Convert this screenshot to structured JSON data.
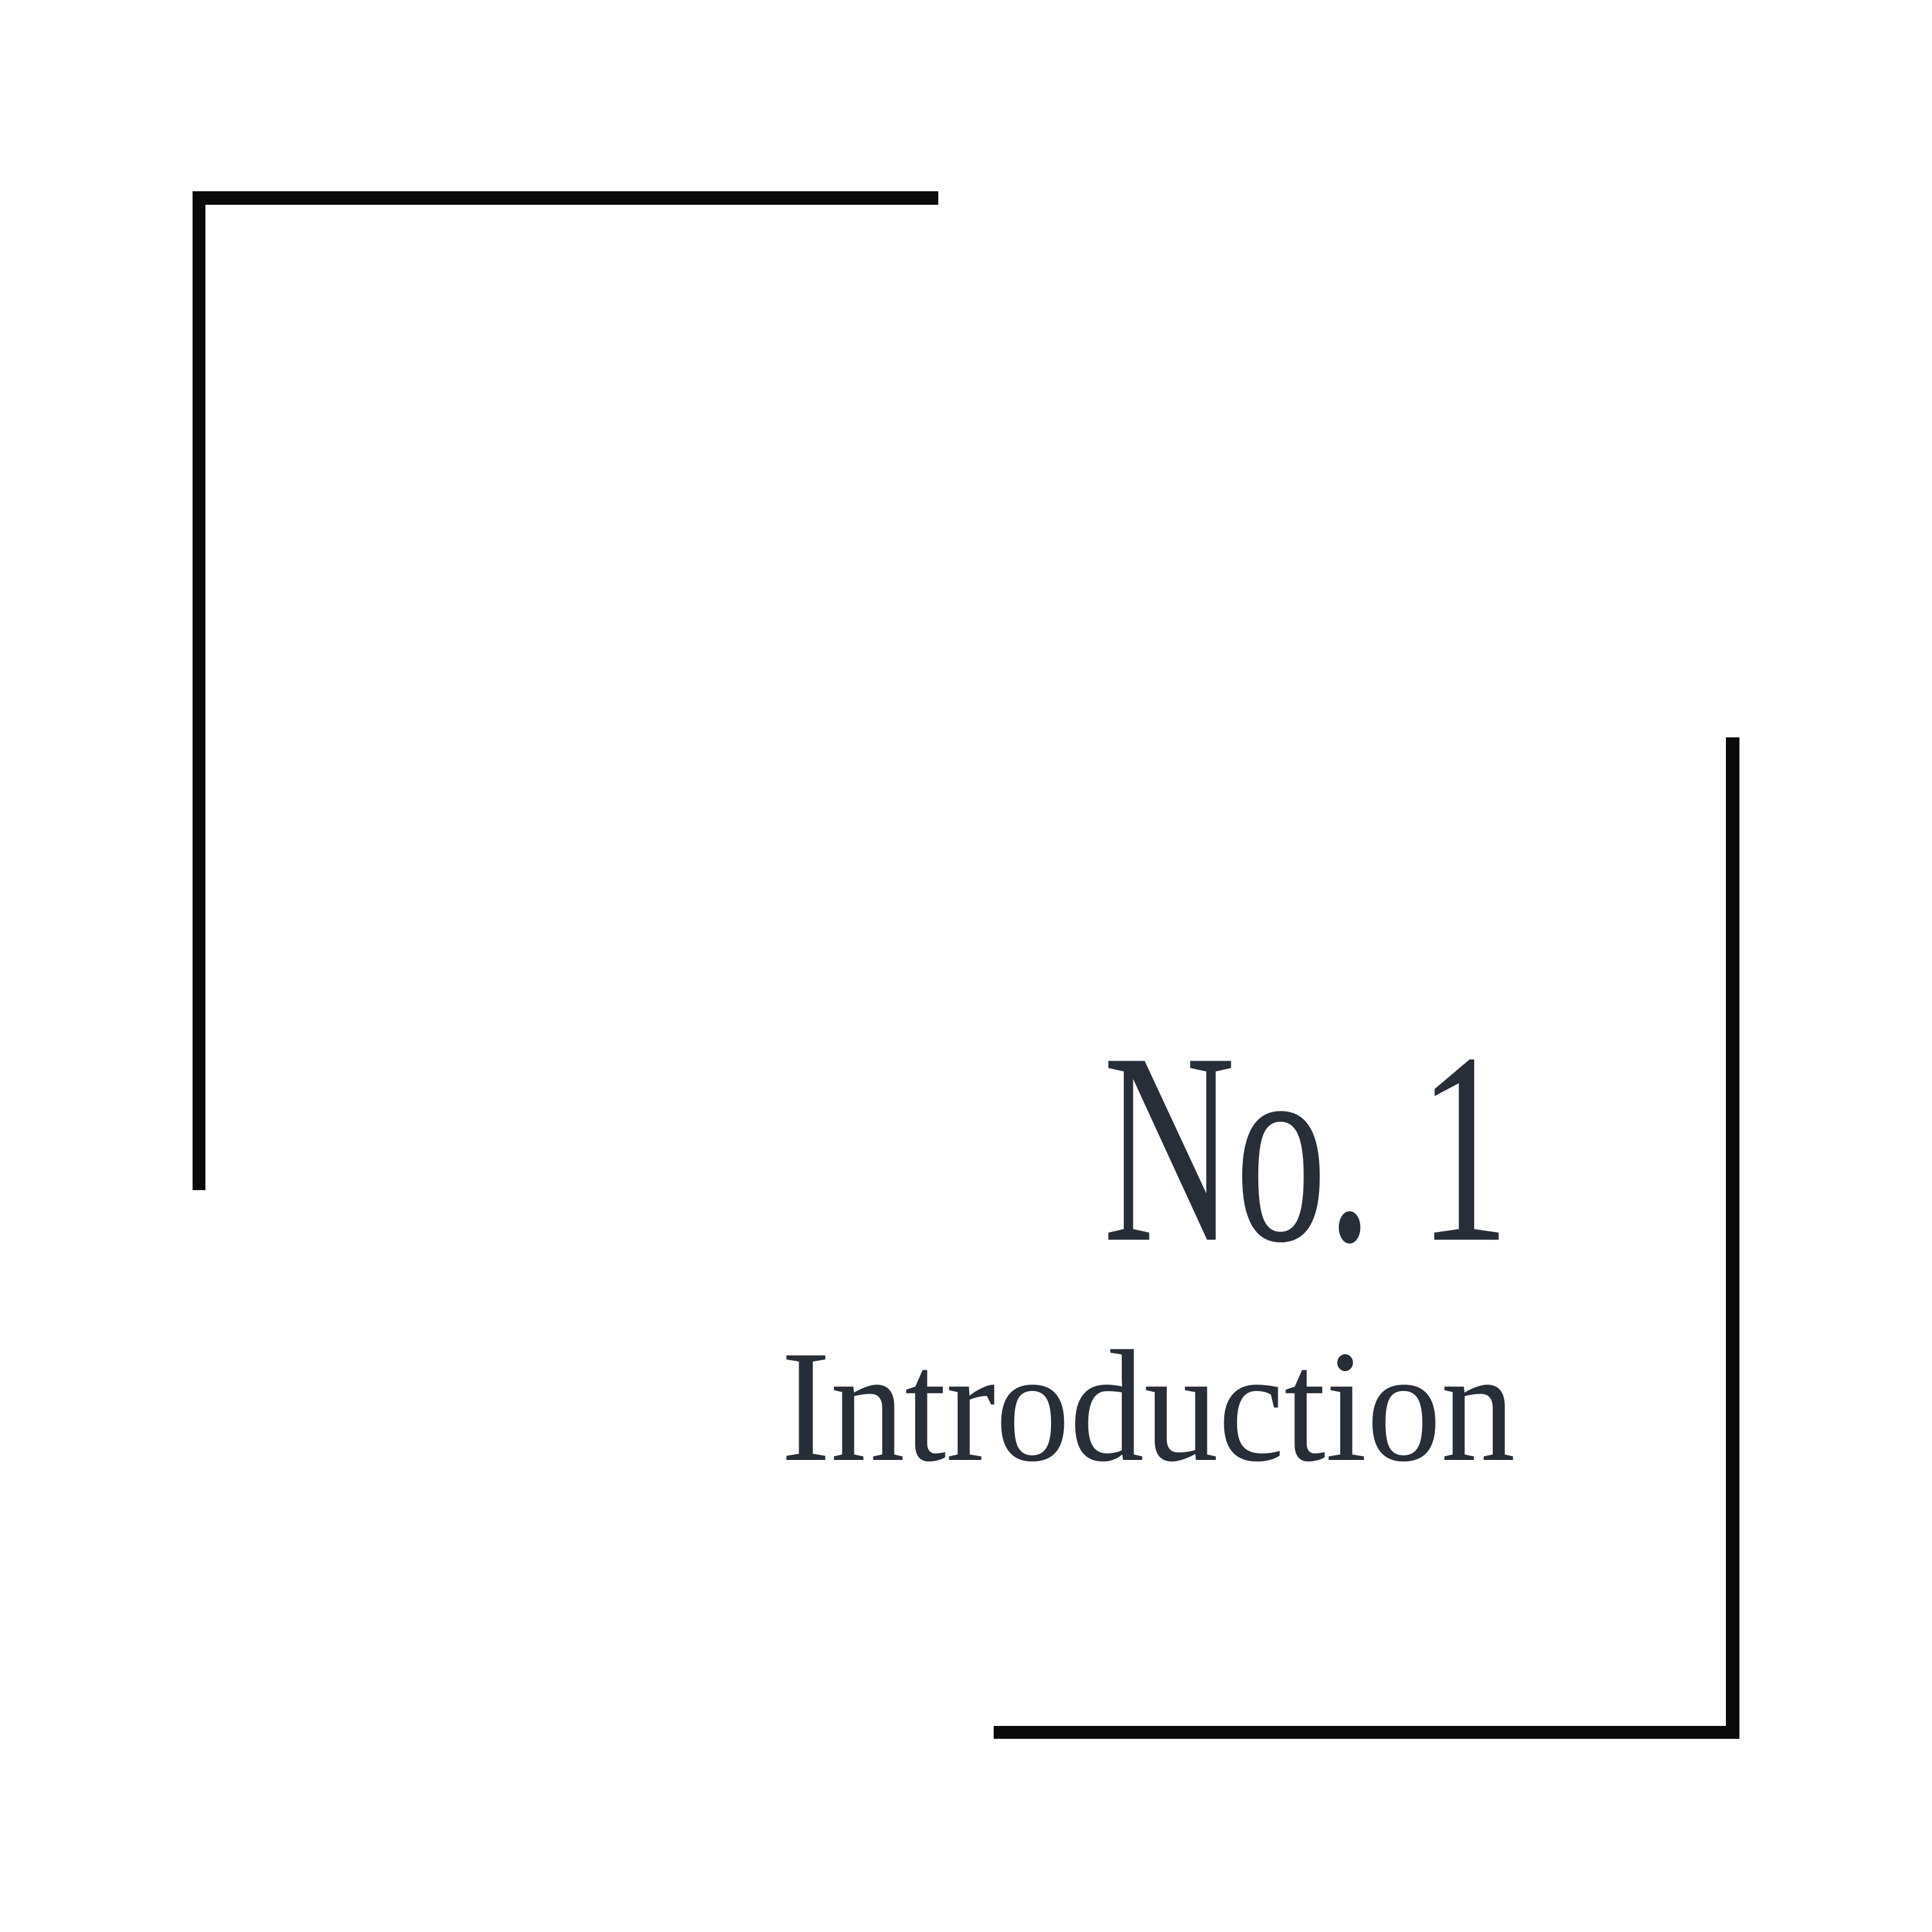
{
  "page": {
    "background_color": "#ffffff",
    "line_color": "#0a0a0a",
    "text_color": "#272e38"
  },
  "chapter": {
    "number_label": "No. 1",
    "title": "Introduction"
  }
}
